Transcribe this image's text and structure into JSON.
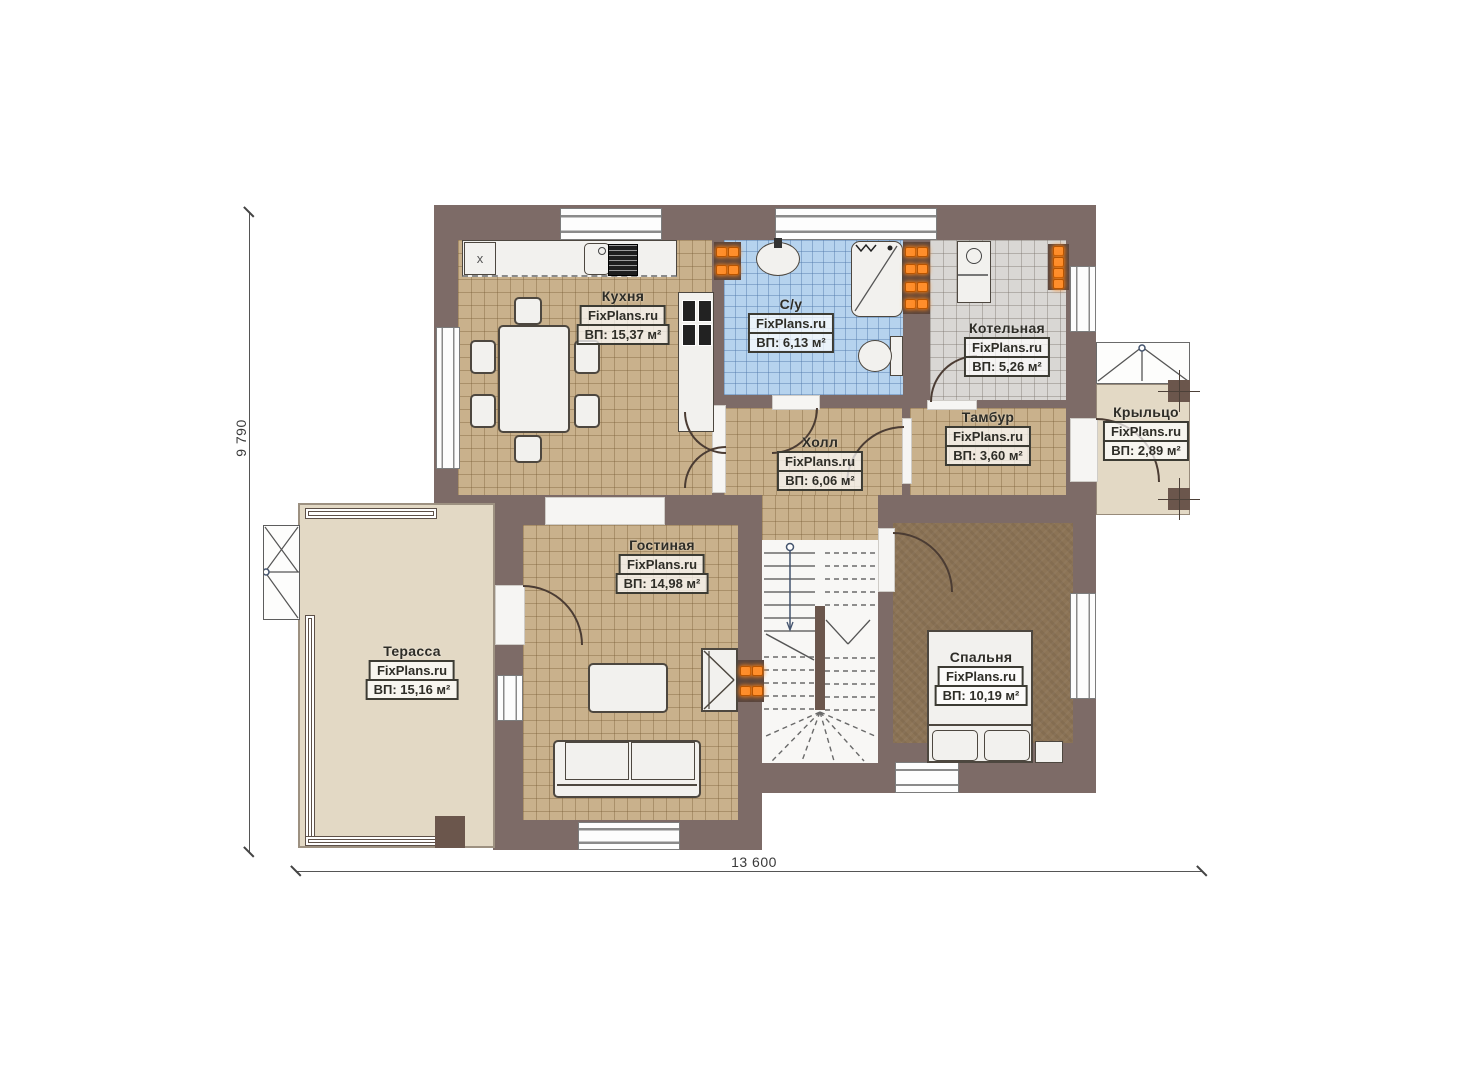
{
  "brand": "FixPlans.ru",
  "dimensions": {
    "height_label": "9 790",
    "width_label": "13 600"
  },
  "markers": {
    "appliance": "x"
  },
  "rooms": {
    "kitchen": {
      "name": "Кухня",
      "area": "ВП: 15,37 м²"
    },
    "bathroom": {
      "name": "С/у",
      "area": "ВП: 6,13 м²"
    },
    "boiler": {
      "name": "Котельная",
      "area": "ВП: 5,26 м²"
    },
    "hall": {
      "name": "Холл",
      "area": "ВП: 6,06 м²"
    },
    "tambour": {
      "name": "Тамбур",
      "area": "ВП: 3,60 м²"
    },
    "porch": {
      "name": "Крыльцо",
      "area": "ВП: 2,89 м²"
    },
    "living": {
      "name": "Гостиная",
      "area": "ВП: 14,98 м²"
    },
    "terrace": {
      "name": "Терасса",
      "area": "ВП: 15,16 м²"
    },
    "bedroom": {
      "name": "Спальня",
      "area": "ВП: 10,19 м²"
    }
  }
}
